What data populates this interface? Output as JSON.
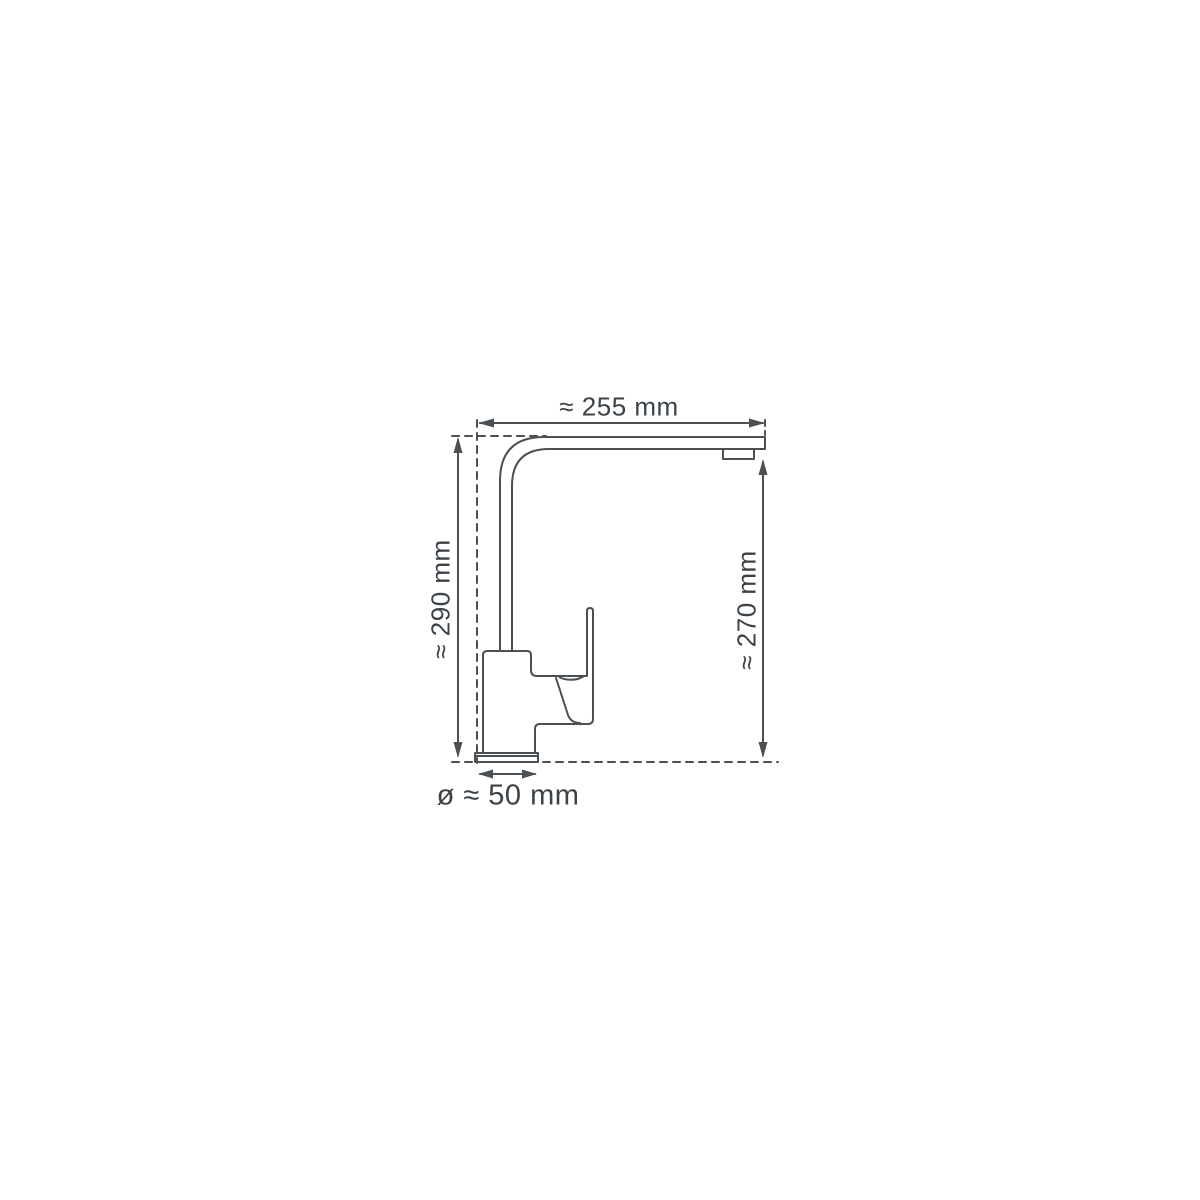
{
  "diagram": {
    "type": "technical-dimension-drawing",
    "subject": "kitchen faucet side profile",
    "background_color": "#ffffff",
    "line_color": "#4b5055",
    "text_color": "#3b4248",
    "dimensions": {
      "spout_reach": {
        "label": "≈ 255 mm",
        "value": 255,
        "unit": "mm",
        "approx": true,
        "orientation": "horizontal",
        "position": "top"
      },
      "total_height": {
        "label": "≈ 290 mm",
        "value": 290,
        "unit": "mm",
        "approx": true,
        "orientation": "vertical",
        "position": "left"
      },
      "spout_height": {
        "label": "≈ 270 mm",
        "value": 270,
        "unit": "mm",
        "approx": true,
        "orientation": "vertical",
        "position": "right"
      },
      "base_diameter": {
        "label": "ø ≈ 50 mm",
        "value": 50,
        "unit": "mm",
        "approx": true,
        "orientation": "horizontal",
        "position": "bottom"
      }
    }
  }
}
